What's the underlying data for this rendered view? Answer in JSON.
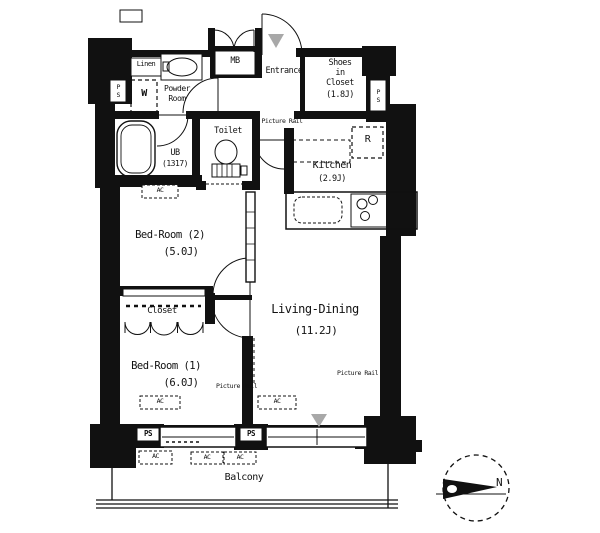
{
  "plan": {
    "rooms": {
      "entrance": "Entrance",
      "shoes_closet": {
        "l1": "Shoes",
        "l2": "in",
        "l3": "Closet",
        "l4": "(1.8J)"
      },
      "powder_room": {
        "l1": "Powder",
        "l2": "Room"
      },
      "linen": "Linen",
      "unit_bath": {
        "l1": "UB",
        "l2": "(1317)"
      },
      "toilet": "Toilet",
      "kitchen": {
        "l1": "Kitchen",
        "l2": "(2.9J)"
      },
      "bedroom2": {
        "l1": "Bed-Room (2)",
        "l2": "(5.0J)"
      },
      "closet": "Closet",
      "bedroom1": {
        "l1": "Bed-Room (1)",
        "l2": "(6.0J)"
      },
      "living_dining": {
        "l1": "Living-Dining",
        "l2": "(11.2J)"
      },
      "balcony": "Balcony"
    },
    "labels": {
      "meter_box": "MB",
      "pipe_space": "PS",
      "air_conditioner": "AC",
      "refrigerator": "R",
      "washer": "W",
      "picture_rail": "Picture Rail",
      "north": "N"
    },
    "colors": {
      "wall": "#111111",
      "marker_gray": "#a8a8a8",
      "background": "#ffffff"
    }
  }
}
